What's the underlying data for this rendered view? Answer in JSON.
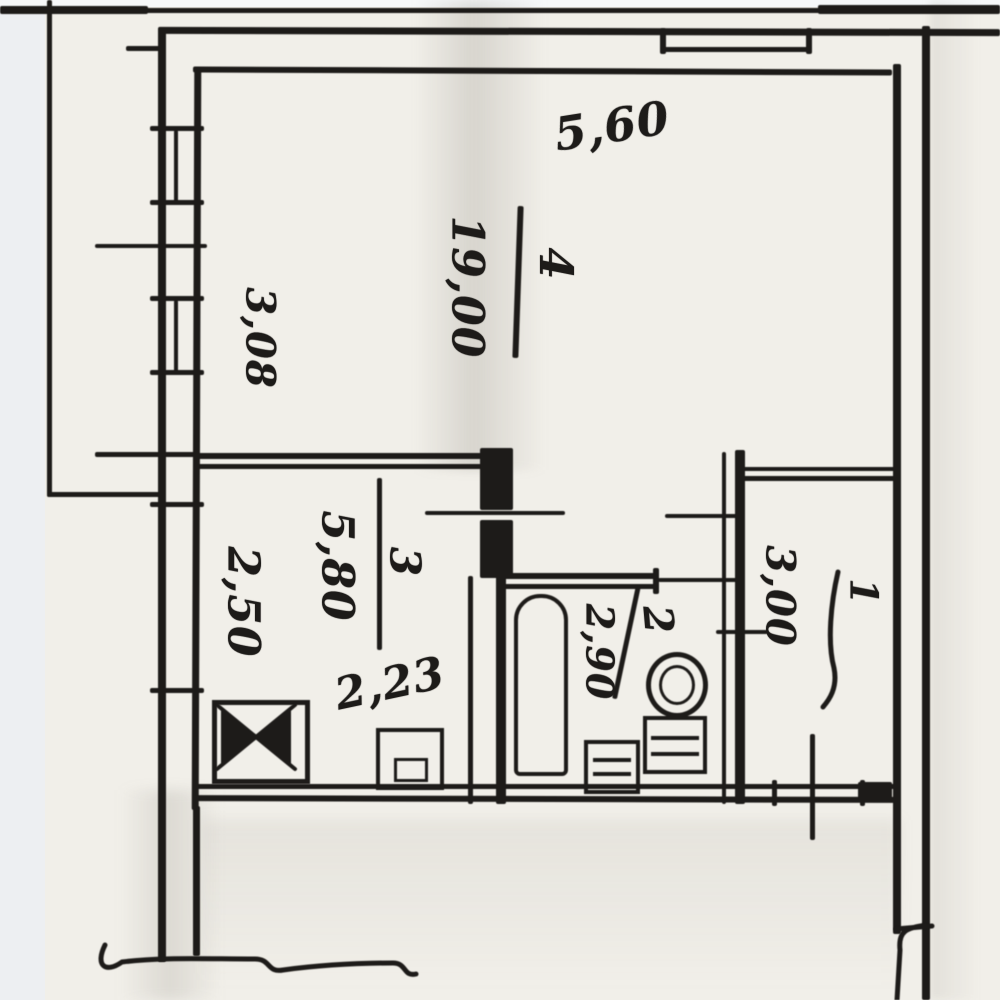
{
  "plan": {
    "dim_top": "5,60",
    "dim_left": "3,08",
    "rooms": {
      "living": {
        "number": "4",
        "area": "19,00"
      },
      "kitchen": {
        "number": "3",
        "area": "5,80",
        "dim_width": "2,23",
        "dim_height": "2,50"
      },
      "bath": {
        "number": "2",
        "area": "2,90"
      },
      "hall": {
        "number": "1",
        "area": "3,00"
      }
    },
    "colors": {
      "paper": "#f1efe9",
      "ink": "#1d1b19"
    },
    "icons": [
      "bathtub-icon",
      "toilet-icon",
      "washbasin-icon",
      "stove-icon",
      "kitchen-sink-icon",
      "break-line-icon"
    ]
  }
}
